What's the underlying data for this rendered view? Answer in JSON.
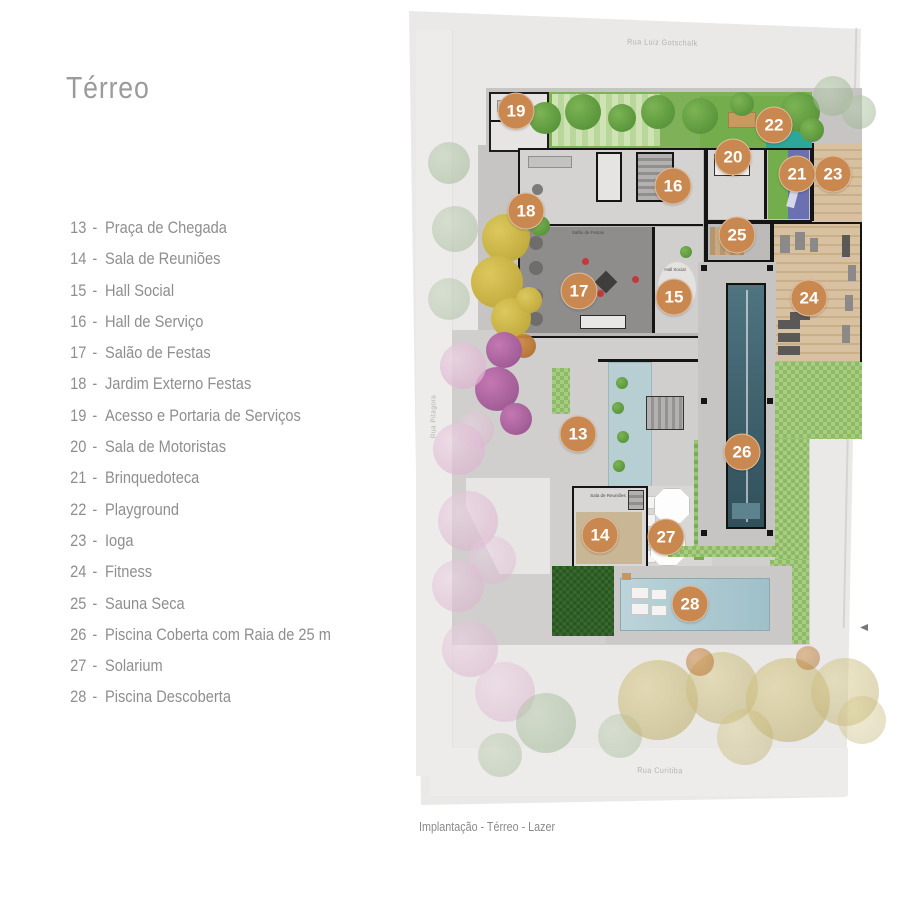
{
  "page": {
    "title": "Térreo",
    "caption": "Implantação - Térreo - Lazer"
  },
  "legend": {
    "separator": "-",
    "items": [
      {
        "num": "13",
        "label": "Praça de Chegada"
      },
      {
        "num": "14",
        "label": "Sala de Reuniões"
      },
      {
        "num": "15",
        "label": "Hall Social"
      },
      {
        "num": "16",
        "label": "Hall de Serviço"
      },
      {
        "num": "17",
        "label": "Salão de Festas"
      },
      {
        "num": "18",
        "label": "Jardim Externo Festas"
      },
      {
        "num": "19",
        "label": "Acesso e Portaria de Serviços"
      },
      {
        "num": "20",
        "label": "Sala de Motoristas"
      },
      {
        "num": "21",
        "label": "Brinquedoteca"
      },
      {
        "num": "22",
        "label": "Playground"
      },
      {
        "num": "23",
        "label": "Ioga"
      },
      {
        "num": "24",
        "label": "Fitness"
      },
      {
        "num": "25",
        "label": "Sauna Seca"
      },
      {
        "num": "26",
        "label": "Piscina Coberta com Raia de 25 m"
      },
      {
        "num": "27",
        "label": "Solarium"
      },
      {
        "num": "28",
        "label": "Piscina Descoberta"
      }
    ]
  },
  "plan": {
    "streets": {
      "top": "Rua Luiz Gotschalk",
      "left": "Rua Pitagora",
      "bottom": "Rua Curitiba"
    },
    "room_labels": {
      "festas": "Salão de Festas",
      "hall": "Hall Social",
      "reunioes": "Sala de Reuniões"
    },
    "colors": {
      "badge": "#c9884f",
      "covered_pool": "#41626e",
      "open_pool": "#aac7cf",
      "lawn": "#74ad4b",
      "wood_deck": "#cdb38f"
    },
    "badges": [
      {
        "num": "13",
        "x": 578,
        "y": 434
      },
      {
        "num": "14",
        "x": 600,
        "y": 535
      },
      {
        "num": "15",
        "x": 674,
        "y": 297
      },
      {
        "num": "16",
        "x": 673,
        "y": 186
      },
      {
        "num": "17",
        "x": 579,
        "y": 291
      },
      {
        "num": "18",
        "x": 526,
        "y": 211
      },
      {
        "num": "19",
        "x": 516,
        "y": 111
      },
      {
        "num": "20",
        "x": 733,
        "y": 157
      },
      {
        "num": "21",
        "x": 797,
        "y": 174
      },
      {
        "num": "22",
        "x": 774,
        "y": 125
      },
      {
        "num": "23",
        "x": 833,
        "y": 174
      },
      {
        "num": "24",
        "x": 809,
        "y": 298
      },
      {
        "num": "25",
        "x": 737,
        "y": 235
      },
      {
        "num": "26",
        "x": 742,
        "y": 452
      },
      {
        "num": "27",
        "x": 666,
        "y": 537
      },
      {
        "num": "28",
        "x": 690,
        "y": 604
      }
    ]
  }
}
